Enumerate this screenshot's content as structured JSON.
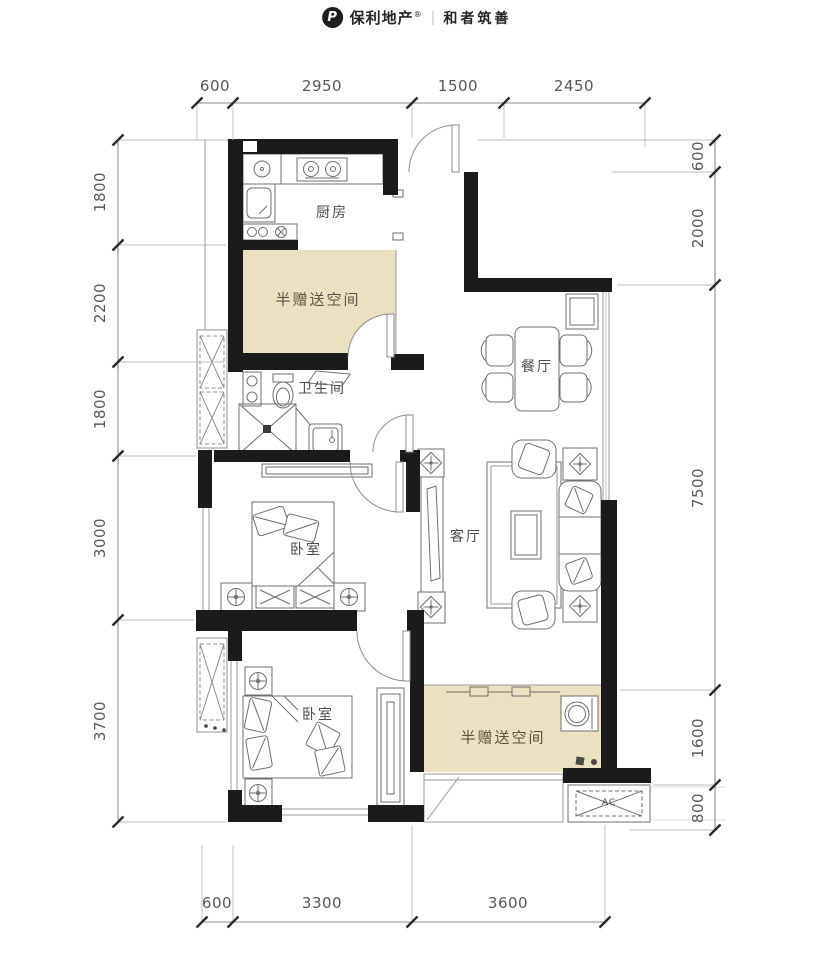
{
  "logo": {
    "mark": "P",
    "brand": "保利地产",
    "registered": "®",
    "divider": "|",
    "slogan": "和者筑善"
  },
  "rooms": {
    "kitchen": "厨房",
    "gift_top": "半赠送空间",
    "bathroom": "卫生间",
    "bedroom1": "卧室",
    "dining": "餐厅",
    "living": "客厅",
    "bedroom2": "卧室",
    "gift_bottom": "半赠送空间",
    "ac_unit": "AC"
  },
  "dimensions": {
    "top": [
      "600",
      "2950",
      "1500",
      "2450"
    ],
    "bottom": [
      "600",
      "3300",
      "3600"
    ],
    "left": [
      "1800",
      "2200",
      "1800",
      "3000",
      "3700"
    ],
    "right": [
      "600",
      "2000",
      "7500",
      "1600",
      "800"
    ]
  },
  "colors": {
    "wall": "#1b1b1b",
    "gift_fill": "#ece0c2",
    "furniture_line": "#6f6f6f",
    "dimension_line": "#8c8c8c",
    "dimension_text": "#585858"
  }
}
